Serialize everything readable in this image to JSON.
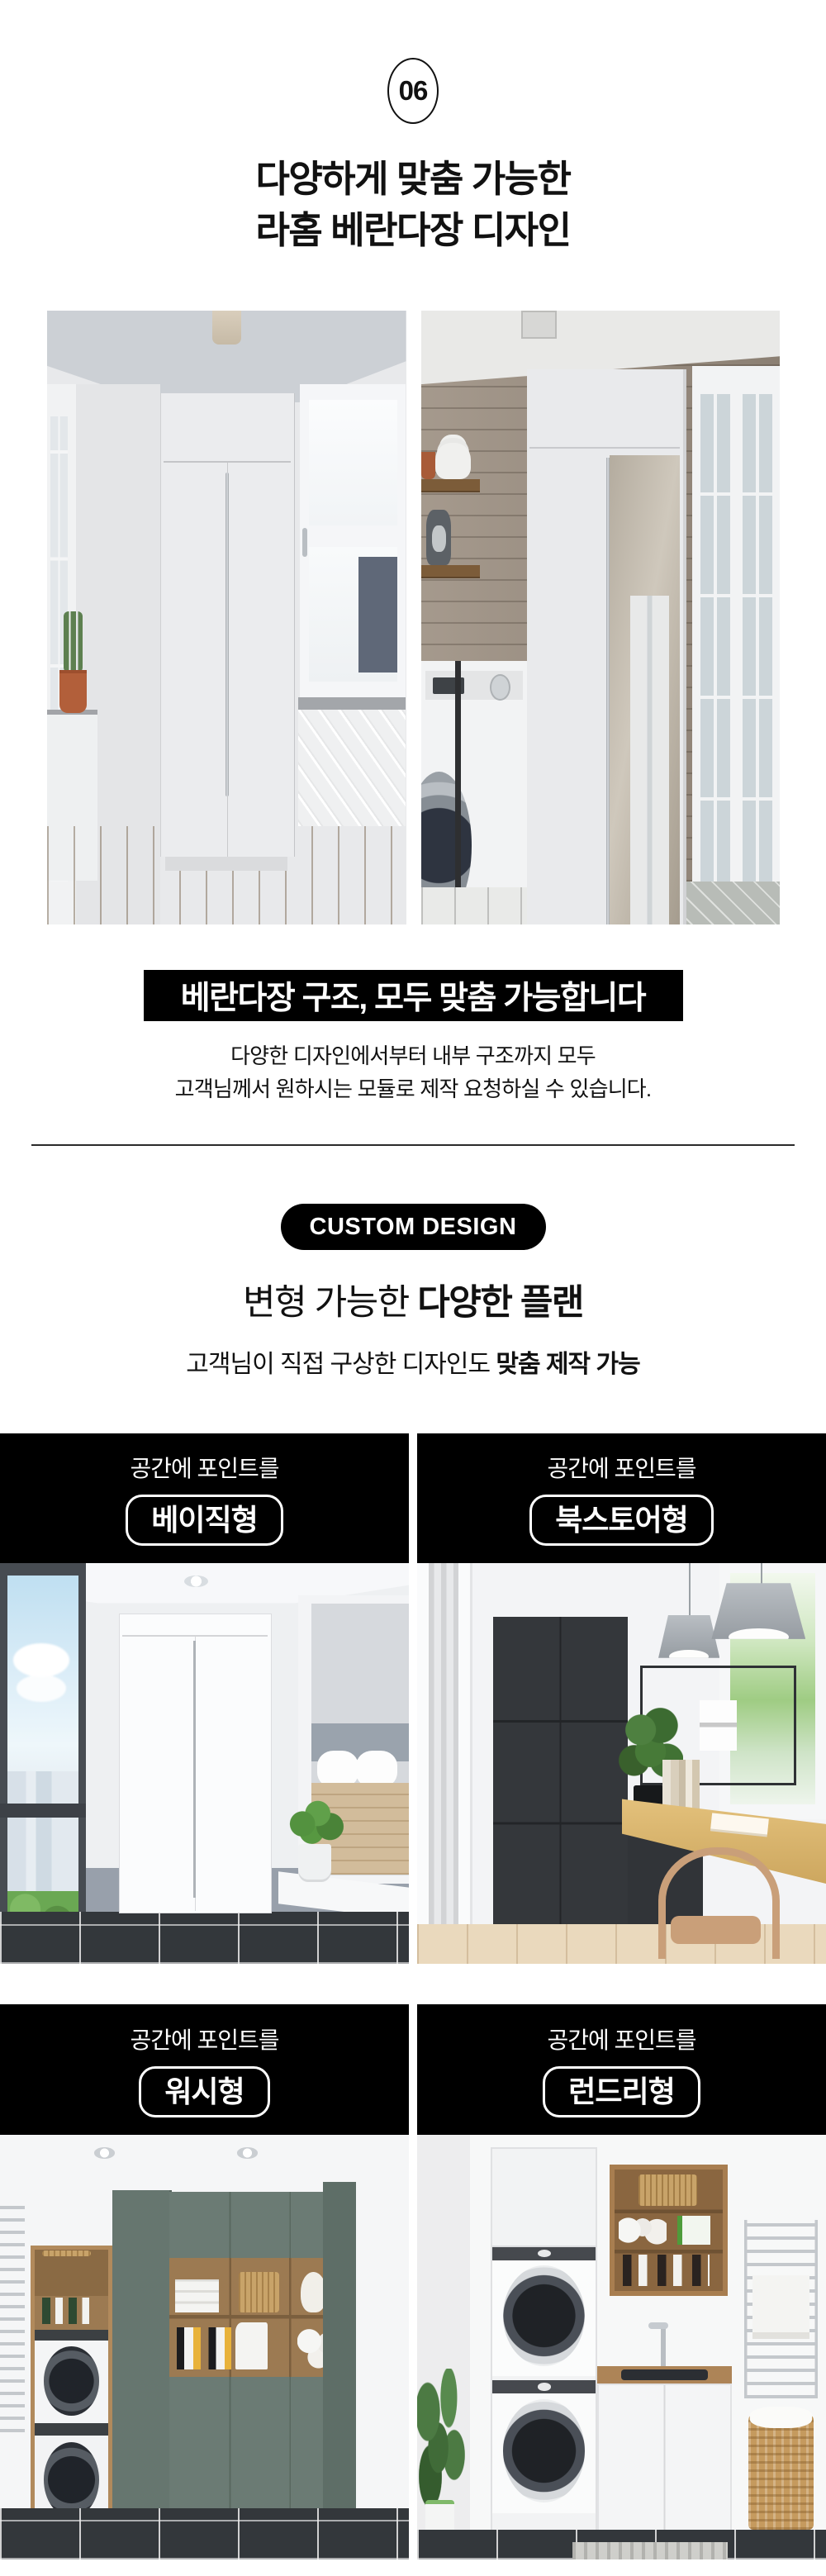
{
  "badge": {
    "number": "06"
  },
  "intro": {
    "title_line1": "다양하게 맞춤 가능한",
    "title_line2": "라홈 베란다장 디자인"
  },
  "banner": {
    "text": "베란다장 구조, 모두 맞춤 가능합니다"
  },
  "description": {
    "line1": "다양한 디자인에서부터 내부 구조까지 모두",
    "line2": "고객님께서 원하시는 모듈로 제작 요청하실 수 있습니다."
  },
  "custom_design": {
    "badge": "CUSTOM DESIGN",
    "heading_regular": "변형 가능한 ",
    "heading_bold": "다양한 플랜",
    "subtitle_regular": "고객님이 직접 구상한 디자인도 ",
    "subtitle_bold": "맞춤 제작 가능"
  },
  "cards": [
    {
      "eyebrow": "공간에 포인트를",
      "label": "베이직형"
    },
    {
      "eyebrow": "공간에 포인트를",
      "label": "북스토어형"
    },
    {
      "eyebrow": "공간에 포인트를",
      "label": "워시형"
    },
    {
      "eyebrow": "공간에 포인트를",
      "label": "런드리형"
    }
  ],
  "colors": {
    "banner_bg": "#000000",
    "banner_text": "#ffffff",
    "card_header_bg": "#000000",
    "body_text": "#111111",
    "sage_green_cabinet": "#6b7b74",
    "charcoal_cabinet": "#34373b",
    "wood_shelf": "#a87e50",
    "dark_tile_floor": "#33373b"
  }
}
